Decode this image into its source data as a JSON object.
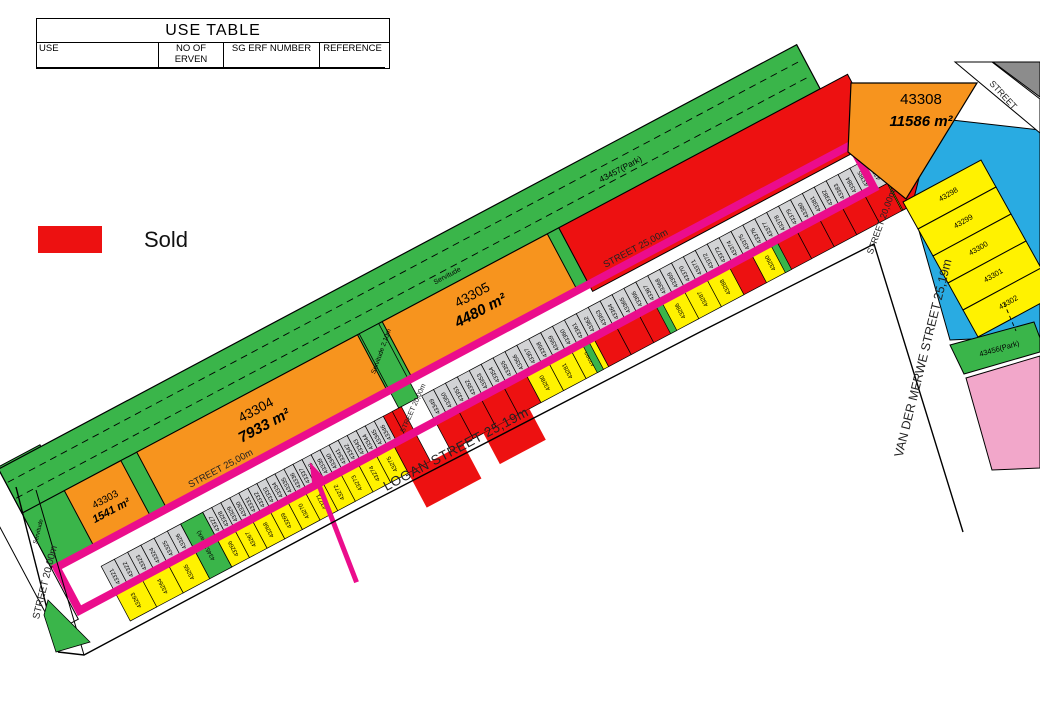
{
  "table": {
    "title": "USE TABLE",
    "headers": [
      "USE",
      "NO OF ERVEN",
      "SG ERF NUMBER",
      "REFERENCE"
    ],
    "rows": [
      {
        "use": "RESIDENTIAL 1",
        "erven": "40",
        "erf": "43263 - 43302",
        "ref": "yellow"
      },
      {
        "use": "RESIDENTIAL 2",
        "erven": "6",
        "erf": "43303 - 43308",
        "ref": "orange"
      },
      {
        "use": "RESIDENTIAL 3",
        "erven": "10",
        "erf": "43309 - 43318",
        "ref": "hatch"
      },
      {
        "use": "BUSINESS 3",
        "erven": "1",
        "erf": "43319",
        "ref": "pink"
      },
      {
        "use": "INSTITUTION",
        "erven": "1",
        "erf": "43320",
        "ref": "blue"
      },
      {
        "use": "SPECIAL (Entrepreneurs Village: Dwelling unit with associated business activities)",
        "erven": "126",
        "erf": "43321 - 43446",
        "ref": "gray"
      },
      {
        "use": "SPECIAL (For Office and / or dwelling units purpose)",
        "erven": "1",
        "erf": "43447",
        "ref": "gray"
      },
      {
        "use": "SPECIAL (For Transport service)",
        "erven": "3",
        "erf": "43448 - 43450",
        "ref": "gray"
      }
    ]
  },
  "legend": {
    "sold_label": "Sold"
  },
  "colors": {
    "yellow": "#FFF200",
    "orange": "#F7941E",
    "green": "#3AB54A",
    "gray": "#D2D3D5",
    "red": "#ED1111",
    "highlight": "#EB0D8C",
    "pink": "#F2A7CA",
    "blue": "#29ABE2"
  },
  "map": {
    "park": {
      "label": "43457(Park)",
      "servitude": "Servitude",
      "servitude2": "Servitude 2,10m"
    },
    "orange_parcels": [
      {
        "id": "43303",
        "area": "1541 m²"
      },
      {
        "id": "43304",
        "area": "7933 m²"
      },
      {
        "id": "43305",
        "area": "4480 m²"
      },
      {
        "id": "43308",
        "area": "11586 m²"
      }
    ],
    "streets": {
      "street25": "STREET 25,00m",
      "logan": "LOGAN STREET 25,19m",
      "vdm": "VAN DER MERWE STREET 25,19m",
      "street20": "STREET 20,00m",
      "cross": "STREET 20,00m",
      "top_right": "STREET"
    },
    "green_parcels": {
      "row_parcel": "43453(Park)",
      "east_parcel": "43456(Park)"
    },
    "gray_segments": [
      {
        "from": 43321,
        "to": 43326
      },
      {
        "from": 43327,
        "to": 43348,
        "sold": [
          43347,
          43348
        ]
      },
      {
        "from": 43349,
        "to": 43386
      }
    ],
    "yellow_segments": [
      {
        "from": 43263,
        "to": 43265
      },
      {
        "from": 43266,
        "to": 43275
      },
      {
        "from": 43276,
        "to": 43297,
        "sold": [
          43276,
          43277,
          43278,
          43279,
          43283,
          43284,
          43285,
          43289,
          43291,
          43292,
          43293,
          43294,
          43295,
          43297
        ]
      }
    ],
    "east_stack": [
      "43298",
      "43299",
      "43300",
      "43301",
      "43302"
    ]
  }
}
